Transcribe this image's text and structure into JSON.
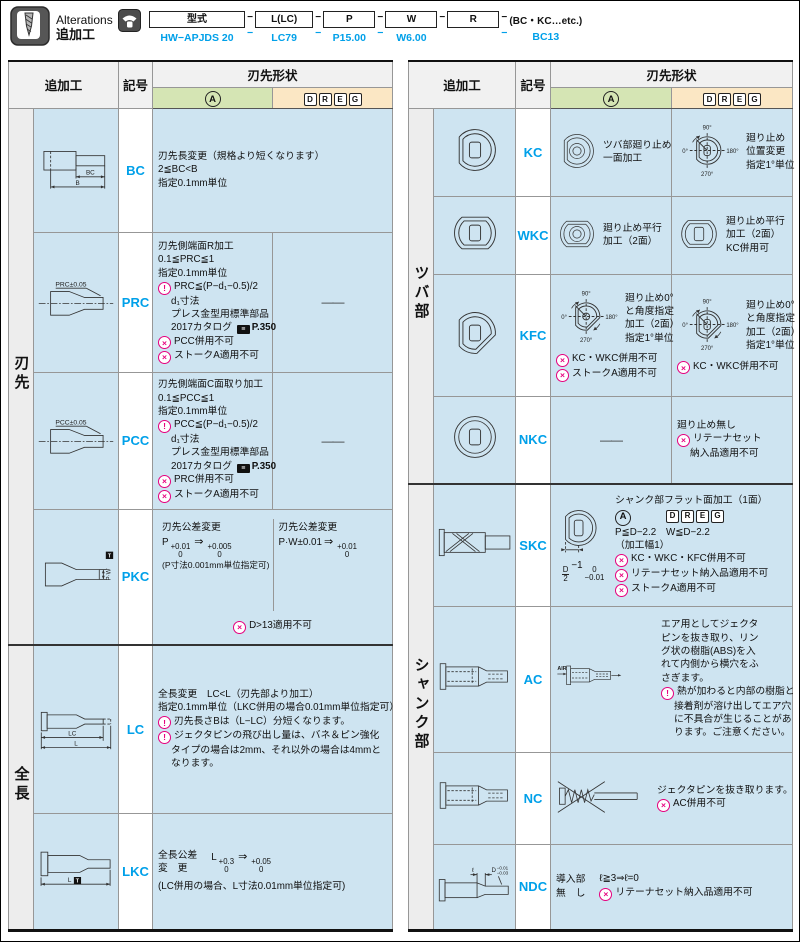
{
  "table_headers": {
    "addwork": "追加工",
    "symbol": "記号",
    "shape": "刃先形状",
    "a_letter": "A",
    "dreg_letters": [
      "D",
      "R",
      "E",
      "G"
    ]
  },
  "colors": {
    "accent_blue": "#00a0e9",
    "magenta": "#e6007e",
    "cell_blue": "#cee4f1",
    "type_a_green": "#d5e5b4",
    "type_dreg_orange": "#fbe7c4"
  },
  "header": {
    "title_en": "Alterations",
    "title_ja": "追加工",
    "format": {
      "columns": [
        {
          "box": "型式",
          "ex": "HW−APJDS 20"
        },
        {
          "sep": "−",
          "ex": "−"
        },
        {
          "box": "L(LC)",
          "ex": "LC79"
        },
        {
          "sep": "−",
          "ex": "−"
        },
        {
          "box": "P",
          "ex": "P15.00"
        },
        {
          "sep": "−",
          "ex": "−"
        },
        {
          "box": "W",
          "ex": "W6.00"
        },
        {
          "sep": "−",
          "ex": ""
        },
        {
          "box": "R",
          "ex": ""
        },
        {
          "sep": "−",
          "ex": "−"
        },
        {
          "tail": "(BC・KC…etc.)",
          "ex": "BC13"
        }
      ]
    }
  },
  "left_table": {
    "rows": [
      {
        "symbol": "BC",
        "section": {
          "label": "刃先",
          "span": 4
        },
        "diagram": {
          "type": "punch_bc",
          "labels": [
            "BC",
            "B"
          ]
        },
        "cells": [
          {
            "span": 2,
            "lines": [
              {
                "t": "刃先長変更（規格より短くなります）"
              },
              {
                "t": "2≦BC<B"
              },
              {
                "t": "指定0.1mm単位"
              }
            ]
          }
        ]
      },
      {
        "symbol": "PRC",
        "diagram": {
          "type": "punch_taper",
          "labels": [
            "PRC±0.05"
          ]
        },
        "cells": [
          {
            "lines": [
              {
                "t": "刃先側端面R加工"
              },
              {
                "t": "0.1≦PRC≦1"
              },
              {
                "t": "指定0.1mm単位"
              },
              {
                "i": "info",
                "t": "PRC≦(P−d₁−0.5)/2"
              },
              {
                "ind": 1,
                "t": "d₁寸法"
              },
              {
                "ind": 1,
                "t": "プレス金型用標準部品"
              },
              {
                "ind": 1,
                "book": "2017カタログ",
                "book_label": "P.350"
              },
              {
                "i": "warn",
                "t": "PCC併用不可"
              },
              {
                "i": "warn",
                "t": "ストークA適用不可"
              }
            ]
          },
          {
            "dash": "——"
          }
        ]
      },
      {
        "symbol": "PCC",
        "diagram": {
          "type": "punch_taper",
          "labels": [
            "PCC±0.05"
          ]
        },
        "cells": [
          {
            "lines": [
              {
                "t": "刃先側端面C面取り加工"
              },
              {
                "t": "0.1≦PCC≦1"
              },
              {
                "t": "指定0.1mm単位"
              },
              {
                "i": "info",
                "t": "PCC≦(P−d₁−0.5)/2"
              },
              {
                "ind": 1,
                "t": "d₁寸法"
              },
              {
                "ind": 1,
                "t": "プレス金型用標準部品"
              },
              {
                "ind": 1,
                "book": "2017カタログ",
                "book_label": "P.350"
              },
              {
                "i": "warn",
                "t": "PRC併用不可"
              },
              {
                "i": "warn",
                "t": "ストークA適用不可"
              }
            ]
          },
          {
            "dash": "——"
          }
        ]
      },
      {
        "symbol": "PKC",
        "diagram": {
          "type": "punch_pkc",
          "labels": [
            "P·W",
            "T"
          ]
        },
        "cells": [
          {
            "span": 2,
            "split": [
              {
                "lines": [
                  {
                    "t": "刃先公差変更"
                  },
                  {
                    "parts": [
                      {
                        "t": "P"
                      },
                      {
                        "stack": [
                          "+0.01",
                          "0"
                        ]
                      },
                      {
                        "t": "⇒"
                      },
                      {
                        "stack": [
                          "+0.005",
                          "0"
                        ]
                      }
                    ]
                  },
                  {
                    "small": 1,
                    "t": "(P寸法0.001mm単位指定可)"
                  }
                ]
              },
              {
                "lines": [
                  {
                    "t": "刃先公差変更"
                  },
                  {
                    "parts": [
                      {
                        "t": "P·W±0.01"
                      },
                      {
                        "t": "⇒"
                      },
                      {
                        "stack": [
                          "+0.01",
                          "0"
                        ]
                      }
                    ]
                  }
                ]
              }
            ],
            "footer": {
              "i": "warn",
              "t": "D>13適用不可"
            }
          }
        ]
      },
      {
        "symbol": "LC",
        "section": {
          "label": "全長",
          "span": 2
        },
        "diagram": {
          "type": "punch_lc",
          "labels": [
            "LC",
            "L"
          ]
        },
        "cells": [
          {
            "span": 2,
            "lines": [
              {
                "t": "全長変更　LC<L（刃先部より加工）"
              },
              {
                "t": "指定0.1mm単位（LKC併用の場合0.01mm単位指定可）"
              },
              {
                "i": "info",
                "t": "刃先長さBは（L−LC）分短くなります。"
              },
              {
                "i": "info",
                "t": "ジェクタピンの飛び出し量は、バネ＆ピン強化"
              },
              {
                "ind": 1,
                "t": "タイプの場合は2mm、それ以外の場合は4mmと"
              },
              {
                "ind": 1,
                "t": "なります。"
              }
            ]
          }
        ]
      },
      {
        "symbol": "LKC",
        "diagram": {
          "type": "punch_lkc",
          "labels": [
            "L",
            "T"
          ]
        },
        "cells": [
          {
            "span": 2,
            "blocks": [
              {
                "lines": [
                  {
                    "t": "全長公差"
                  },
                  {
                    "t": "変　更"
                  }
                ]
              },
              {
                "lines": [
                  {
                    "parts": [
                      {
                        "t": "L"
                      },
                      {
                        "stack": [
                          "+0.3",
                          "0"
                        ]
                      },
                      {
                        "t": "⇒"
                      },
                      {
                        "stack": [
                          "+0.05",
                          "0"
                        ]
                      }
                    ]
                  }
                ]
              }
            ],
            "below": [
              {
                "t": "(LC併用の場合、L寸法0.01mm単位指定可)"
              }
            ]
          }
        ]
      }
    ]
  },
  "right_table": {
    "rows": [
      {
        "symbol": "KC",
        "section": {
          "label": "ツバ部",
          "span": 4
        },
        "diagram": {
          "type": "collar",
          "variant": "flat1"
        },
        "cells": [
          {
            "icon": {
              "type": "collar_rings",
              "variant": "flat1"
            },
            "lines": [
              {
                "t": "ツバ部廻り止め"
              },
              {
                "t": "一面加工"
              }
            ]
          },
          {
            "icon": {
              "type": "dial",
              "variant": "flat1",
              "labels": [
                "90°",
                "0°",
                "180°",
                "270°"
              ]
            },
            "lines": [
              {
                "t": "廻り止め"
              },
              {
                "t": "位置変更"
              },
              {
                "t": "指定1°単位"
              }
            ]
          }
        ]
      },
      {
        "symbol": "WKC",
        "diagram": {
          "type": "collar",
          "variant": "flat2"
        },
        "cells": [
          {
            "icon": {
              "type": "collar_rings",
              "variant": "flat2"
            },
            "lines": [
              {
                "t": "廻り止め平行"
              },
              {
                "t": "加工（2面）"
              }
            ]
          },
          {
            "icon": {
              "type": "collar",
              "variant": "flat2"
            },
            "lines": [
              {
                "t": "廻り止め平行"
              },
              {
                "t": "加工（2面）"
              },
              {
                "t": "KC併用可"
              }
            ]
          }
        ]
      },
      {
        "symbol": "KFC",
        "diagram": {
          "type": "collar",
          "variant": "flat_angle"
        },
        "cells": [
          {
            "icon": {
              "type": "dial",
              "variant": "flat_angle_circle",
              "labels": [
                "90°",
                "0°",
                "180°",
                "270°"
              ]
            },
            "lines": [
              {
                "t": "廻り止め0°"
              },
              {
                "t": "と角度指定"
              },
              {
                "t": "加工（2面）"
              },
              {
                "t": "指定1°単位"
              }
            ],
            "below": [
              {
                "i": "warn",
                "t": "KC・WKC併用不可"
              },
              {
                "i": "warn",
                "t": "ストークA適用不可"
              }
            ]
          },
          {
            "icon": {
              "type": "dial",
              "variant": "flat_angle_rect",
              "labels": [
                "90°",
                "0°",
                "180°",
                "270°"
              ]
            },
            "lines": [
              {
                "t": "廻り止め0°"
              },
              {
                "t": "と角度指定"
              },
              {
                "t": "加工（2面）"
              },
              {
                "t": "指定1°単位"
              }
            ],
            "below": [
              {
                "i": "warn",
                "t": "KC・WKC併用不可"
              }
            ]
          }
        ]
      },
      {
        "symbol": "NKC",
        "diagram": {
          "type": "collar",
          "variant": "round"
        },
        "cells": [
          {
            "dash": "——"
          },
          {
            "lines": [
              {
                "t": "廻り止め無し"
              },
              {
                "i": "warn",
                "t": "リテーナセット"
              },
              {
                "ind": 1,
                "t": "納入品適用不可"
              }
            ]
          }
        ]
      },
      {
        "symbol": "SKC",
        "section": {
          "label": "シャンク部",
          "span": 4
        },
        "diagram": {
          "type": "punch_shank"
        },
        "cells": [
          {
            "span": 2,
            "icon": {
              "type": "skc_circle"
            },
            "icon_dim": {
              "parts": [
                {
                  "stack": [
                    "D",
                    "2"
                  ],
                  "frac": 1
                },
                {
                  "t": "−1"
                },
                {
                  "stack": [
                    "0",
                    "−0.01"
                  ]
                }
              ]
            },
            "lines": [
              {
                "t": "シャンク部フラット面加工（1面）"
              },
              {
                "badges": 1
              },
              {
                "t": "P≦D−2.2　W≦D−2.2"
              },
              {
                "t": "（加工幅1）"
              },
              {
                "i": "warn",
                "t": "KC・WKC・KFC併用不可"
              },
              {
                "i": "warn",
                "t": "リテーナセット納入品適用不可"
              },
              {
                "i": "warn",
                "t": "ストークA適用不可"
              }
            ]
          }
        ]
      },
      {
        "symbol": "AC",
        "diagram": {
          "type": "punch_dashed"
        },
        "cells": [
          {
            "span": 2,
            "icon": {
              "type": "ac_diagram",
              "labels": [
                "AIR"
              ]
            },
            "lines": [
              {
                "t": "エア用としてジェクタ"
              },
              {
                "t": "ピンを抜き取り、リン"
              },
              {
                "t": "グ状の樹脂(ABS)を入"
              },
              {
                "t": "れて内側から横穴をふ"
              },
              {
                "t": "さぎます。"
              },
              {
                "i": "info",
                "t": "熱が加わると内部の樹脂と"
              },
              {
                "ind": 1,
                "t": "接着剤が溶け出してエア穴"
              },
              {
                "ind": 1,
                "t": "に不具合が生じることがあ"
              },
              {
                "ind": 1,
                "t": "ります。ご注意ください。"
              }
            ]
          }
        ]
      },
      {
        "symbol": "NC",
        "diagram": {
          "type": "punch_dashed"
        },
        "cells": [
          {
            "span": 2,
            "icon": {
              "type": "nc_diagram"
            },
            "lines": [
              {
                "t": "ジェクタピンを抜き取ります。"
              },
              {
                "i": "warn",
                "t": "AC併用不可"
              }
            ]
          }
        ]
      },
      {
        "symbol": "NDC",
        "diagram": {
          "type": "punch_ndc",
          "labels": [
            "ℓ",
            "D",
            "−0.01",
            "−0.03"
          ]
        },
        "cells": [
          {
            "span": 2,
            "blocks": [
              {
                "lines": [
                  {
                    "t": "導入部"
                  },
                  {
                    "t": "無　し"
                  }
                ]
              },
              {
                "lines": [
                  {
                    "t": "ℓ≧3⇒ℓ=0"
                  },
                  {
                    "i": "warn",
                    "t": "リテーナセット納入品適用不可"
                  }
                ]
              }
            ]
          }
        ]
      }
    ]
  }
}
